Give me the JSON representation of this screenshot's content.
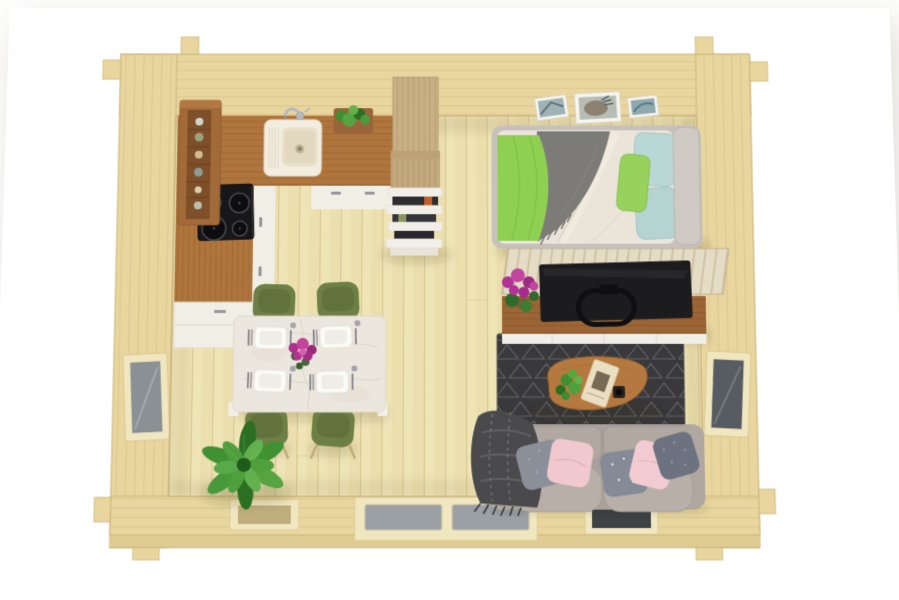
{
  "meta": {
    "description": "3D top-down render of a one-room log cabin floor plan on a white background",
    "view": "top-down perspective render",
    "background": "#ffffff"
  },
  "palette": {
    "bg": "#ffffff",
    "wall": "#e8d69e",
    "wallLine": "#d2bc82",
    "wallEdge": "#cdb679",
    "wallLip": "#dfcc92",
    "floor": "#ecdfae",
    "floor2": "#f1e6bc",
    "floorLine": "#d8c794",
    "glassLight": "#8a9094",
    "glassDark": "#565c61",
    "doorGlass": "#9aa0a4",
    "frame": "#f0e6c0",
    "counterWood": "#af753c",
    "shelfWood": "#a26a39",
    "cabWhite": "#f1eee5",
    "handle": "#96969c",
    "hob": "#17171a",
    "cabinetWood": "#c9b084",
    "shelfWhite": "#f2efe8",
    "bookDark": "#2c2c31",
    "bedFrame": "#c6c2bb",
    "duvet": "#ebe5d9",
    "blanket": "#7d7b78",
    "throw": "#8fd052",
    "pillowTeal": "#b9d7d5",
    "headboard": "#cfcbc4",
    "slat": "#e5dcc6",
    "slatLine": "#cfc2a4",
    "console": "#9c6535",
    "consoleEdge": "#f1eee6",
    "tv": "#1c1c1f",
    "rug": "#39383b",
    "rugLine": "#6b6a6e",
    "tableWood": "#b5793f",
    "sofa": "#aaa29a",
    "sofaLight": "#b1a9a1",
    "sofaSeat": "#b8b0a8",
    "plaid": "#4a494b",
    "pink": "#f0c8cd",
    "pillowGrey": "#8b8f99",
    "pillowGreyDark": "#6d7280",
    "chair": "#6d7f44",
    "chairDark": "#566636",
    "chairLeg": "#c0a878",
    "marble": "#ece7de",
    "vein": "#d9d2c6",
    "plant": "#3f8f31",
    "plantDark": "#2a6f22",
    "plantLight": "#63b14c",
    "magenta": "#b23394",
    "shadow": "rgba(45,36,12,0.16)"
  },
  "structure": {
    "walls": "pale pine log walls with corner notch joints",
    "floor": "vertical pale pine floor boards",
    "openings": [
      "left wall window",
      "right wall window",
      "rear small window",
      "glazed double door",
      "rear dark window"
    ]
  },
  "rooms": {
    "kitchen": {
      "name": "Kitchen",
      "items": [
        "wall shelf with jars",
        "L-shaped wood counter with white cabinet fronts",
        "white sink with faucet",
        "black induction cooktop with 4 burners",
        "herb planter box",
        "tall wood cabinet",
        "white open shelf with books"
      ]
    },
    "sleeping": {
      "name": "Sleeping area",
      "items": [
        "three framed pictures on wall",
        "double bed",
        "cream duvet",
        "grey blanket",
        "green throw",
        "two light-blue pillows",
        "green pillow",
        "grey headboard",
        "slatted foot panel",
        "media console",
        "flat-screen TV",
        "purple flowers"
      ]
    },
    "living": {
      "name": "Living area",
      "items": [
        "dark triangle-pattern rug",
        "organic wood coffee table",
        "green succulent",
        "book",
        "black cup",
        "grey two-seater sofa",
        "plaid fringed throw",
        "two pink cushions",
        "three grey patterned cushions"
      ]
    },
    "dining": {
      "name": "Dining area",
      "items": [
        "white marble table",
        "four place settings with cutlery and glasses",
        "magenta flower centerpiece",
        "four olive-green chairs",
        "large potted plant"
      ]
    }
  }
}
